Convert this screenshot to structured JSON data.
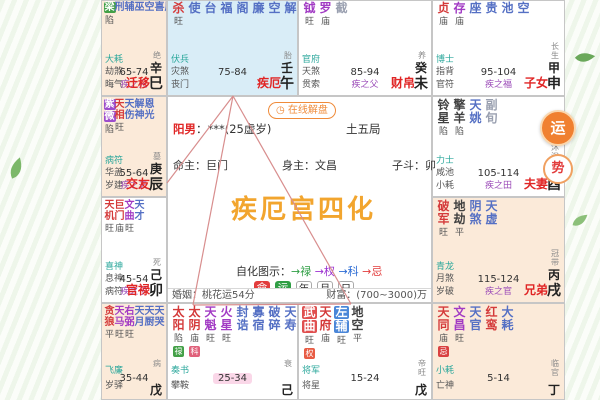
{
  "center": {
    "online_button": "在线解盘",
    "gender_prefix": "阳男",
    "gender_rest": "：***(25虚岁)",
    "bureau": "土五局",
    "ming_master": "命主：巨门",
    "shen_master": "身主：文昌",
    "zidou": "子斗：卯",
    "title": "疾厄宫四化",
    "legend_prefix": "自化图示：",
    "legend_lu": "→禄",
    "legend_quan": "→权",
    "legend_ke": "→科",
    "legend_ji": "→忌",
    "toggle_ming": "命",
    "toggle_yun": "运",
    "toggle_nian": "年",
    "toggle_yue": "月",
    "toggle_ri": "日",
    "marriage": "婚姻：桃花运54分",
    "wealth": "财富：(700~3000)万"
  },
  "float_buttons": {
    "top": "运",
    "bottom": "势"
  },
  "colors": {
    "hua_lu": "#43a047",
    "hua_quan": "#9c4dcc",
    "hua_ke": "#4a86d8",
    "hua_ji": "#e05050",
    "major_star": "#d43a3a",
    "assist_star": "#a23bc4",
    "minor_star": "#5570c4",
    "palace_name": "#e02525",
    "highlight_palace_bg": "#d9edf7",
    "alt_palace_bg": "#fbead9",
    "title_orange": "#f2a52e",
    "current_decade_bg": "#fad7e8"
  },
  "palaces": [
    {
      "key": "si",
      "bg": "peach",
      "narrow": true,
      "row1": true,
      "stars": [
        {
          "t": "梁",
          "c": "major",
          "box": "lu",
          "b": "陷"
        },
        {
          "t": "刑",
          "c": "minor"
        },
        {
          "t": "辅",
          "c": "minor"
        },
        {
          "t": "巫",
          "c": "minor"
        },
        {
          "t": "空",
          "c": "minor"
        },
        {
          "t": "喜",
          "c": "minor"
        },
        {
          "t": "辰",
          "c": "minor"
        }
      ],
      "corner": [
        "大耗",
        "劫煞",
        "晦气"
      ],
      "range": "65-74",
      "rel": "疾之兄",
      "name": "迁移",
      "stage": "绝",
      "stem": "辛",
      "branch": "巳"
    },
    {
      "key": "wu",
      "bg": "blue",
      "row1": true,
      "stars": [
        {
          "t": "杀",
          "c": "major",
          "b": "旺"
        },
        {
          "t": "使",
          "c": "minor"
        },
        {
          "t": "台",
          "c": "minor"
        },
        {
          "t": "福",
          "c": "minor"
        },
        {
          "t": "阁",
          "c": "minor"
        },
        {
          "t": "廉",
          "c": "minor"
        },
        {
          "t": "空",
          "c": "minor"
        },
        {
          "t": "解",
          "c": "minor"
        }
      ],
      "corner": [
        "伏兵",
        "灾煞",
        "丧门"
      ],
      "range": "75-84",
      "rel": "",
      "name": "疾厄",
      "stage": "胎",
      "stem": "壬",
      "branch": "午"
    },
    {
      "key": "wei",
      "bg": "white",
      "row1": true,
      "stars": [
        {
          "t": "钺",
          "c": "assist",
          "b": "旺"
        },
        {
          "t": "罗",
          "c": "assist",
          "b": "庙"
        },
        {
          "t": "截",
          "c": "gray"
        }
      ],
      "corner": [
        "官府",
        "天煞",
        "贯索"
      ],
      "range": "85-94",
      "rel": "疾之父",
      "name": "财帛",
      "stage": "养",
      "stem": "癸",
      "branch": "未"
    },
    {
      "key": "shen",
      "bg": "white",
      "row1": true,
      "stars": [
        {
          "t": "贞",
          "c": "major",
          "b": "庙"
        },
        {
          "t": "存",
          "c": "assist",
          "b": "庙"
        },
        {
          "t": "座",
          "c": "minor"
        },
        {
          "t": "贵",
          "c": "minor"
        },
        {
          "t": "池",
          "c": "minor"
        },
        {
          "t": "空",
          "c": "minor"
        }
      ],
      "corner": [
        "博士",
        "指背",
        "官符"
      ],
      "range": "95-104",
      "rel": "疾之福",
      "name": "子女",
      "stage": "长生",
      "stem": "甲",
      "branch": "申"
    },
    {
      "key": "chen",
      "bg": "peach",
      "narrow": true,
      "stars": [
        {
          "t": "紫微",
          "c": "assist",
          "box": "quan",
          "b": "陷"
        },
        {
          "t": "天相",
          "c": "major",
          "b": "旺"
        },
        {
          "t": "天伤",
          "c": "minor"
        },
        {
          "t": "解神",
          "c": "minor"
        },
        {
          "t": "恩光",
          "c": "minor"
        }
      ],
      "corner": [
        "病符",
        "华盖",
        "岁建"
      ],
      "range": "55-64",
      "rel": "疾之夫",
      "name": "交友",
      "stage": "墓",
      "stem": "庚",
      "branch": "辰"
    },
    {
      "key": "you",
      "bg": "white",
      "stars": [
        {
          "t": "铃星",
          "c": "dark",
          "b": "陷"
        },
        {
          "t": "擎羊",
          "c": "dark",
          "b": "陷"
        },
        {
          "t": "天姚",
          "c": "minor"
        },
        {
          "t": "副旬",
          "c": "gray"
        }
      ],
      "corner": [
        "力士",
        "咸池",
        "小耗"
      ],
      "range": "105-114",
      "rel": "疾之田",
      "name": "夫妻",
      "stage": "沐浴",
      "stem": "乙",
      "branch": "酉"
    },
    {
      "key": "mao",
      "bg": "white",
      "narrow": true,
      "stars": [
        {
          "t": "天机",
          "c": "major",
          "b": "旺"
        },
        {
          "t": "巨门",
          "c": "major",
          "b": "庙"
        },
        {
          "t": "文曲",
          "c": "assist",
          "b": "旺"
        },
        {
          "t": "天才",
          "c": "minor"
        }
      ],
      "corner": [
        "喜神",
        "息神",
        "病符"
      ],
      "range": "45-54",
      "rel": "疾之子",
      "name": "官禄",
      "stage": "死",
      "stem": "己",
      "branch": "卯"
    },
    {
      "key": "xu",
      "bg": "peach",
      "stars": [
        {
          "t": "破军",
          "c": "major",
          "b": "旺"
        },
        {
          "t": "地劫",
          "c": "dark",
          "b": "平"
        },
        {
          "t": "阴煞",
          "c": "minor"
        },
        {
          "t": "天虚",
          "c": "minor"
        }
      ],
      "corner": [
        "青龙",
        "月煞",
        "岁破"
      ],
      "range": "115-124",
      "rel": "疾之官",
      "name": "兄弟",
      "stage": "冠带",
      "stem": "丙",
      "branch": "戌"
    },
    {
      "key": "yin",
      "bg": "peach",
      "narrow": true,
      "cut": true,
      "stars": [
        {
          "t": "贪狼",
          "c": "major",
          "b": "平"
        },
        {
          "t": "天马",
          "c": "assist",
          "b": "旺"
        },
        {
          "t": "右弼",
          "c": "assist",
          "b": "旺"
        },
        {
          "t": "天月",
          "c": "minor"
        },
        {
          "t": "天厨",
          "c": "minor"
        },
        {
          "t": "天哭",
          "c": "minor"
        }
      ],
      "corner": [
        "飞廉",
        "岁驿"
      ],
      "range": "35-44",
      "stage": "病",
      "stem": "戊"
    },
    {
      "key": "chou",
      "bg": "white",
      "cut": true,
      "current": true,
      "stars": [
        {
          "t": "太阳",
          "c": "major",
          "b": "陷",
          "badge": {
            "t": "禄",
            "c": "b-green"
          }
        },
        {
          "t": "太阴",
          "c": "major",
          "b": "庙",
          "badge": {
            "t": "科",
            "c": "b-pink"
          }
        },
        {
          "t": "天魁",
          "c": "assist",
          "b": "旺"
        },
        {
          "t": "火星",
          "c": "assist",
          "b": "旺"
        },
        {
          "t": "封诰",
          "c": "minor"
        },
        {
          "t": "寡宿",
          "c": "minor"
        },
        {
          "t": "破碎",
          "c": "minor"
        },
        {
          "t": "天寿",
          "c": "minor"
        }
      ],
      "corner": [
        "奏书",
        "攀鞍"
      ],
      "range": "25-34",
      "stage": "衰",
      "stem": "己"
    },
    {
      "key": "zi",
      "bg": "white",
      "cut": true,
      "stars": [
        {
          "t": "武曲",
          "c": "major",
          "box": "ji",
          "b": "旺",
          "badge": {
            "t": "权",
            "c": "b-orange"
          }
        },
        {
          "t": "天府",
          "c": "major",
          "b": "庙"
        },
        {
          "t": "左辅",
          "c": "minor",
          "box": "ke",
          "b": "旺"
        },
        {
          "t": "地空",
          "c": "dark",
          "b": "平"
        }
      ],
      "corner": [
        "将军",
        "将星"
      ],
      "range": "15-24",
      "stage": "帝旺",
      "stem": "戊"
    },
    {
      "key": "hai",
      "bg": "peach",
      "cut": true,
      "stars": [
        {
          "t": "天同",
          "c": "major",
          "b": "庙",
          "badge": {
            "t": "忌",
            "c": "b-red"
          }
        },
        {
          "t": "文昌",
          "c": "assist",
          "b": "旺"
        },
        {
          "t": "天官",
          "c": "minor"
        },
        {
          "t": "红鸾",
          "c": "major"
        },
        {
          "t": "大耗",
          "c": "minor"
        }
      ],
      "corner": [
        "小耗",
        "亡神"
      ],
      "range": "5-14",
      "stage": "临官",
      "stem": "丁"
    }
  ]
}
